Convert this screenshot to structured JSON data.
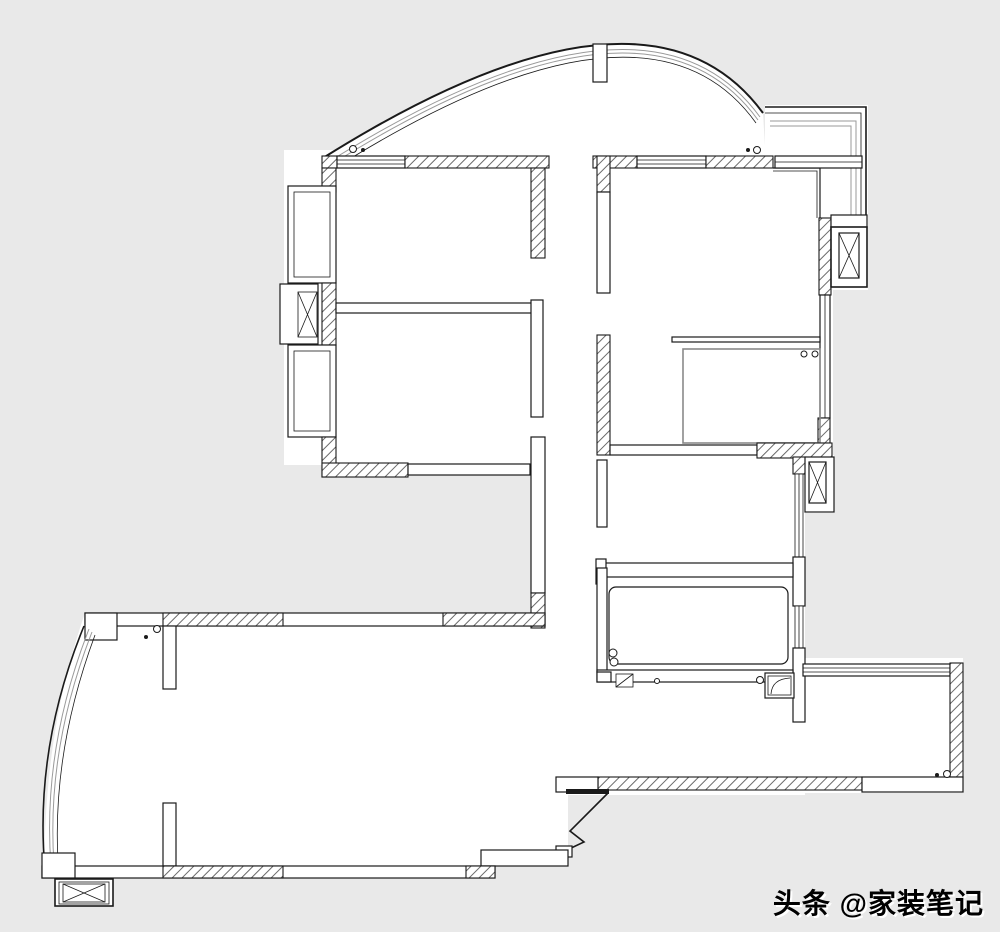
{
  "meta": {
    "type": "floor-plan",
    "description": "black-and-white apartment floor plan drawing on light gray background"
  },
  "colors": {
    "background": "#e9e9e9",
    "paper": "#ffffff",
    "line": "#1a1a1a",
    "glazing_gray": "#9a9a9a",
    "shower_gray": "#8a8a8a",
    "hatch_line": "#6a6a6a"
  },
  "watermark": {
    "text": "头条 @家装笔记"
  }
}
